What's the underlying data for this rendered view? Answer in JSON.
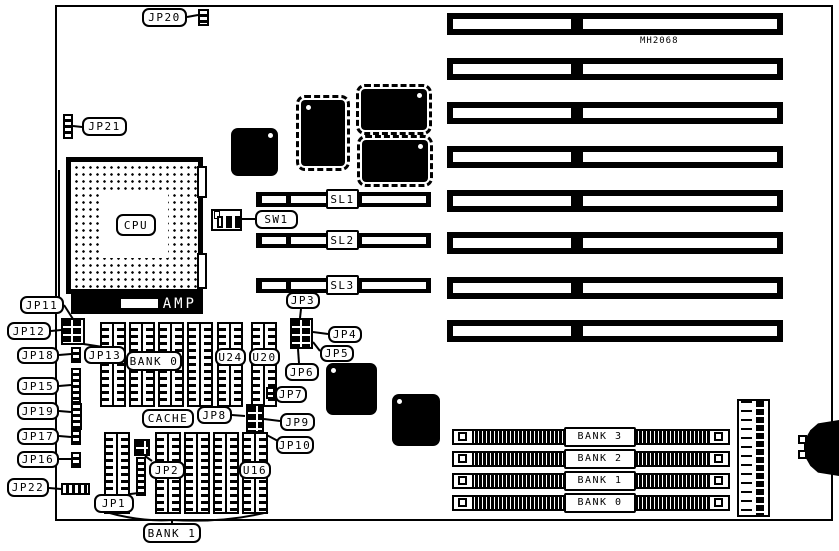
{
  "diagram": {
    "part_number": "MH2068",
    "labels": {
      "jp1": "JP1",
      "jp2": "JP2",
      "jp3": "JP3",
      "jp4": "JP4",
      "jp5": "JP5",
      "jp6": "JP6",
      "jp7": "JP7",
      "jp8": "JP8",
      "jp9": "JP9",
      "jp10": "JP10",
      "jp11": "JP11",
      "jp12": "JP12",
      "jp13": "JP13",
      "jp15": "JP15",
      "jp16": "JP16",
      "jp17": "JP17",
      "jp18": "JP18",
      "jp19": "JP19",
      "jp20": "JP20",
      "jp21": "JP21",
      "jp22": "JP22",
      "sw1": "SW1",
      "sl1": "SL1",
      "sl2": "SL2",
      "sl3": "SL3",
      "cpu": "CPU",
      "amp": "AMP",
      "bank0": "BANK 0",
      "bank1": "BANK 1",
      "cache": "CACHE",
      "u24": "U24",
      "u20": "U20",
      "u16": "U16"
    },
    "simm_banks": [
      {
        "label": "BANK 3"
      },
      {
        "label": "BANK 2"
      },
      {
        "label": "BANK 1"
      },
      {
        "label": "BANK 0"
      }
    ],
    "isa_slot_count": 8,
    "colors": {
      "ink": "#000000",
      "paper": "#ffffff"
    }
  }
}
